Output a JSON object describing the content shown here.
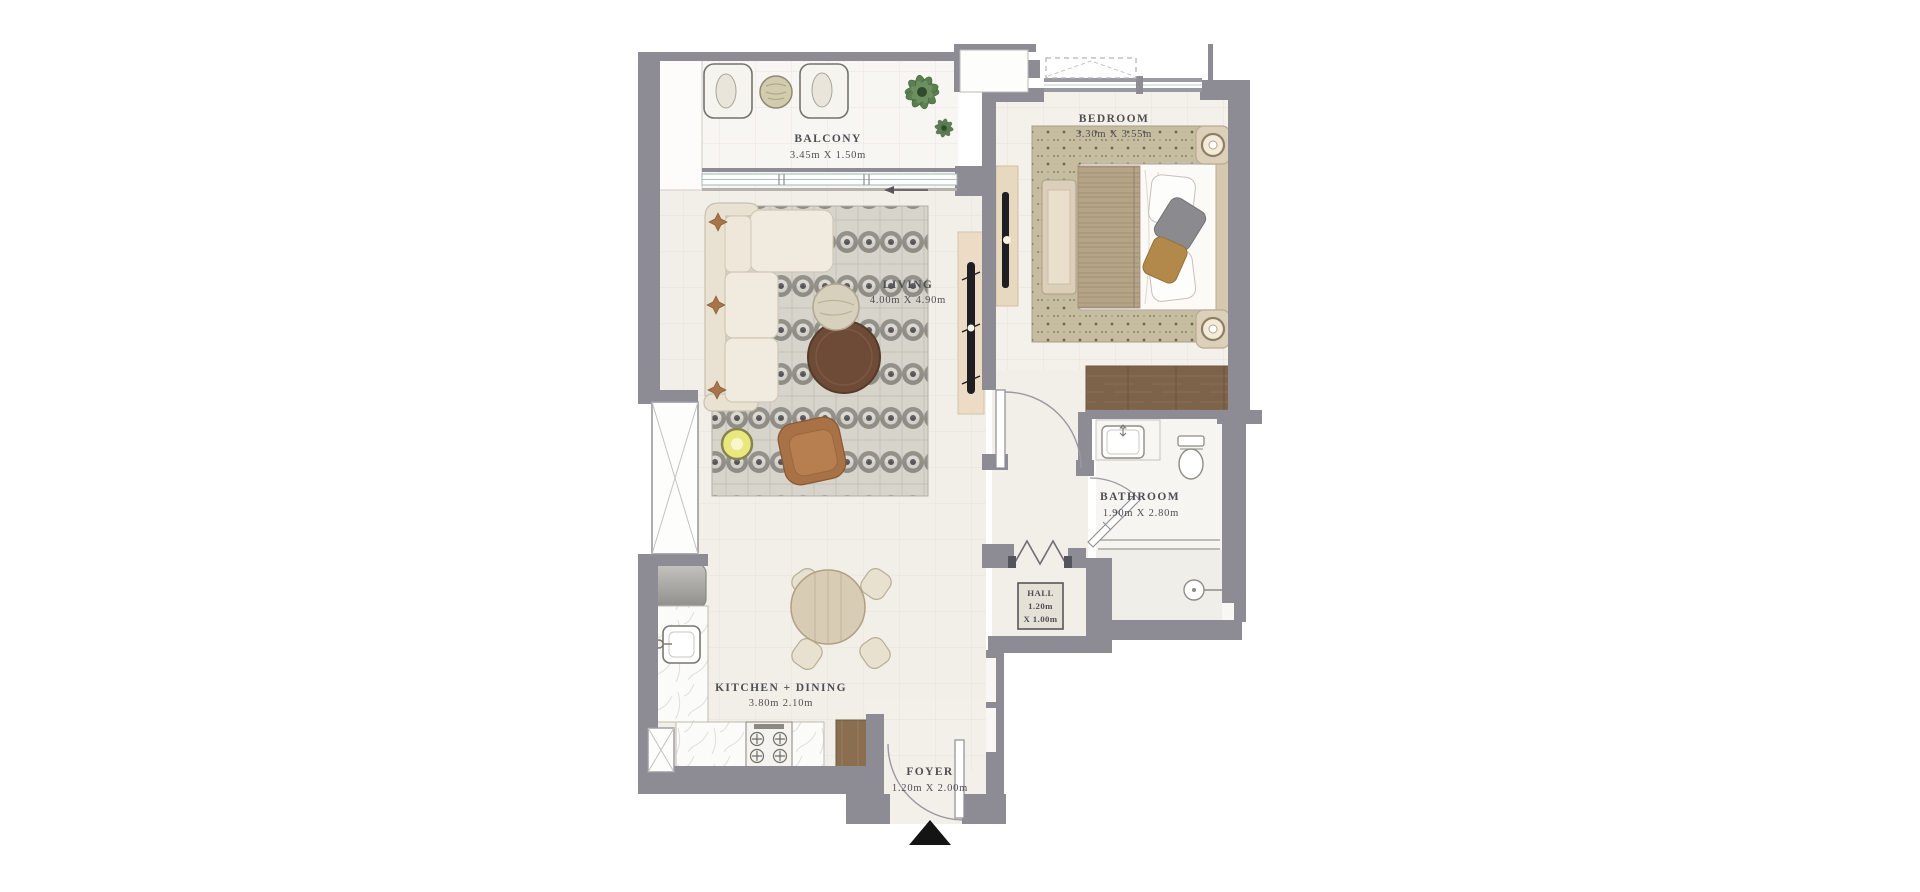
{
  "plan": {
    "wall_color": "#8d8c94",
    "floor_color": "#f2efe9",
    "text_color": "#4e4e55",
    "accent_wood": "#7d6349",
    "rug_living_base": "#d7d4cc",
    "rug_bedroom_base": "#c6bc9f",
    "plant_green": "#5b7f50",
    "rooms": {
      "balcony": {
        "name": "BALCONY",
        "dims": "3.45m X 1.50m"
      },
      "living": {
        "name": "LIVING",
        "dims": "4.00m X 4.90m"
      },
      "bedroom": {
        "name": "BEDROOM",
        "dims": "3.30m X 3.55m"
      },
      "bathroom": {
        "name": "BATHROOM",
        "dims": "1.90m X 2.80m"
      },
      "hall": {
        "name": "HALL",
        "dims_line1": "1.20m",
        "dims_line2": "X 1.00m"
      },
      "kitchen_dining": {
        "name": "KITCHEN + DINING",
        "dims": "3.80m 2.10m"
      },
      "foyer": {
        "name": "FOYER",
        "dims": "1.20m X 2.00m"
      }
    }
  }
}
